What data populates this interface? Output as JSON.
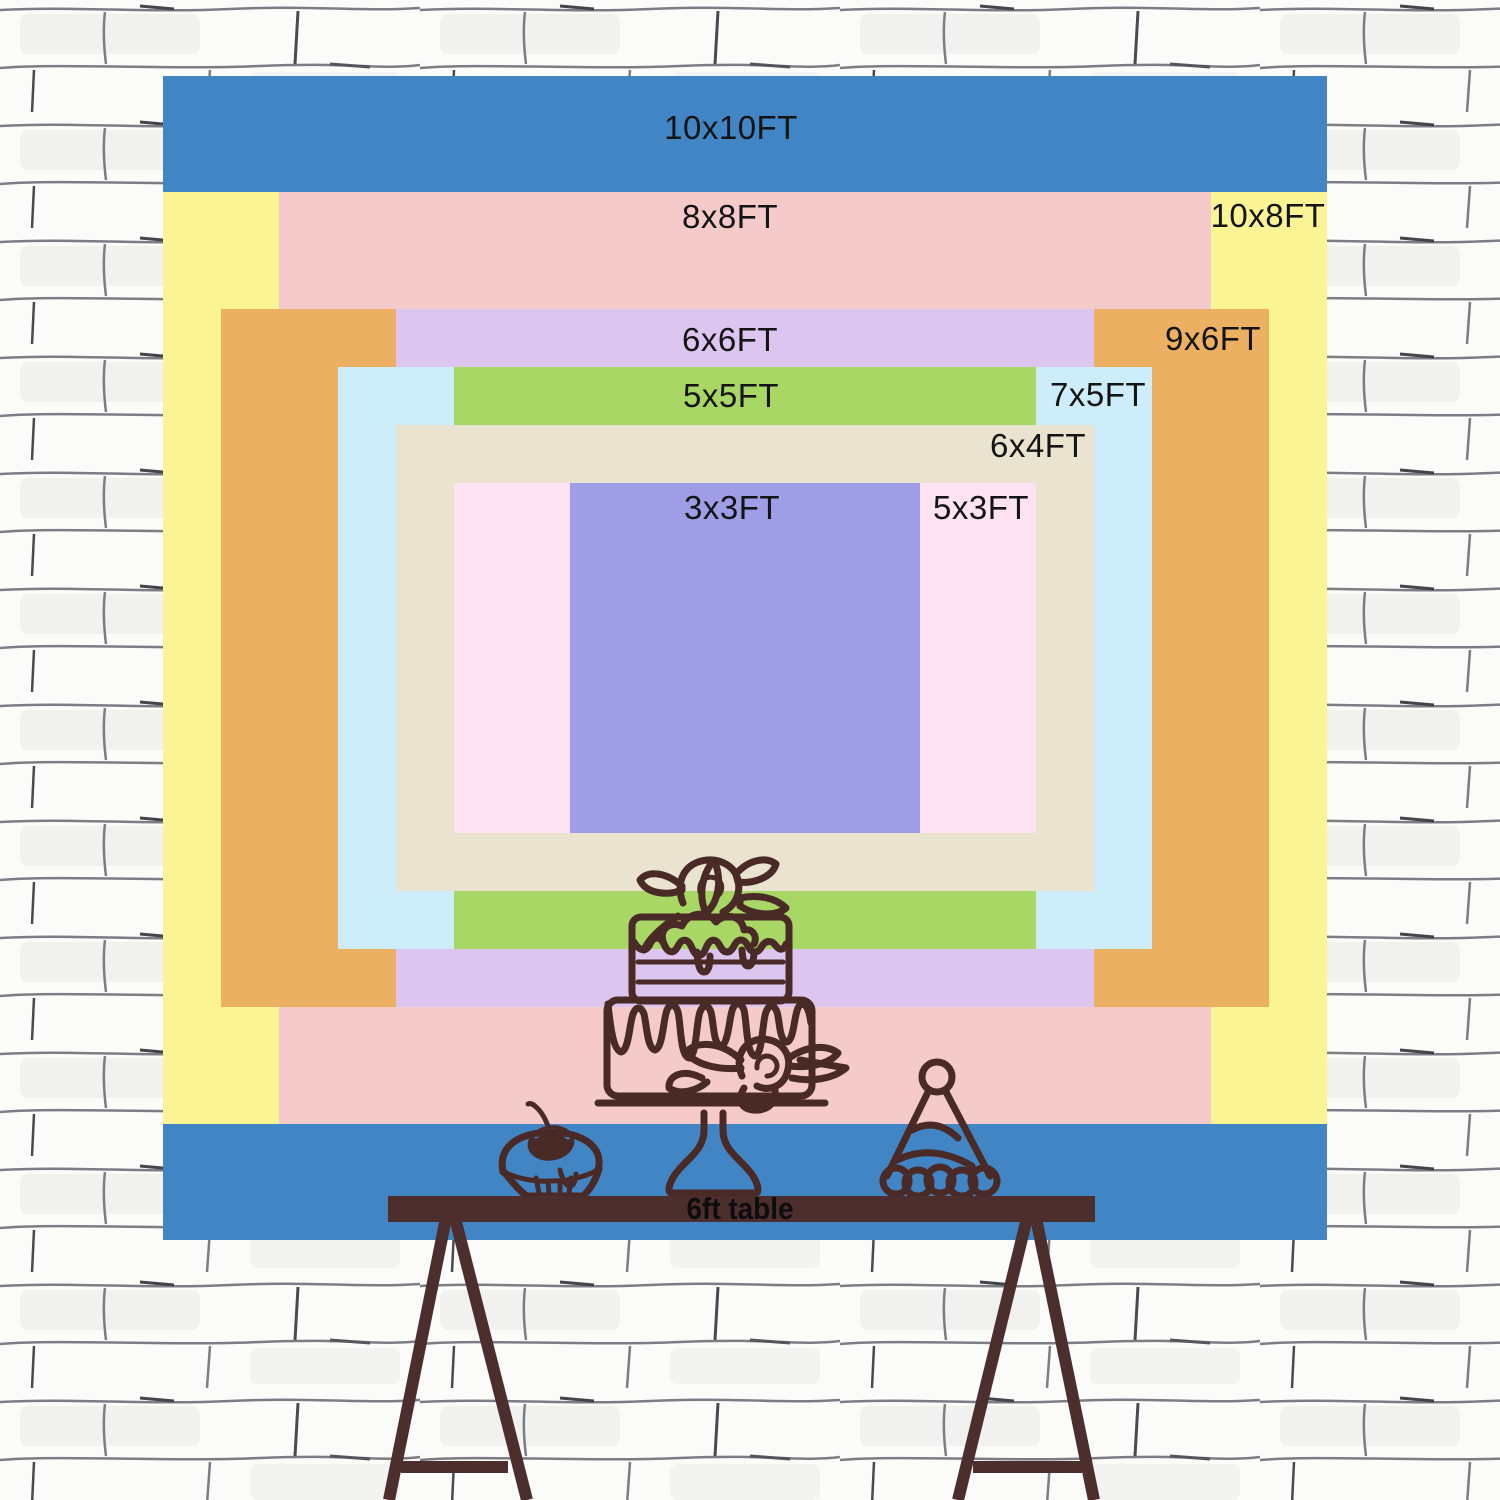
{
  "backdrop": {
    "layers": [
      {
        "id": "10x10ft",
        "label": "10x10FT",
        "width_ft": 10,
        "height_ft": 10,
        "color": "#4285c4"
      },
      {
        "id": "10x8ft",
        "label": "10x8FT",
        "width_ft": 10,
        "height_ft": 8,
        "color": "#fbf495"
      },
      {
        "id": "8x8ft",
        "label": "8x8FT",
        "width_ft": 8,
        "height_ft": 8,
        "color": "#f4caca"
      },
      {
        "id": "9x6ft",
        "label": "9x6FT",
        "width_ft": 9,
        "height_ft": 6,
        "color": "#ecb063"
      },
      {
        "id": "6x6ft",
        "label": "6x6FT",
        "width_ft": 6,
        "height_ft": 6,
        "color": "#dcc5ef"
      },
      {
        "id": "7x5ft",
        "label": "7x5FT",
        "width_ft": 7,
        "height_ft": 5,
        "color": "#cdedfa"
      },
      {
        "id": "5x5ft",
        "label": "5x5FT",
        "width_ft": 5,
        "height_ft": 5,
        "color": "#a8d765"
      },
      {
        "id": "6x4ft",
        "label": "6x4FT",
        "width_ft": 6,
        "height_ft": 4,
        "color": "#e9e3d0"
      },
      {
        "id": "5x3ft",
        "label": "5x3FT",
        "width_ft": 5,
        "height_ft": 3,
        "color": "#fde2f2"
      },
      {
        "id": "3x3ft",
        "label": "3x3FT",
        "width_ft": 3,
        "height_ft": 3,
        "color": "#9f9de6"
      }
    ]
  },
  "table": {
    "label": "6ft table"
  },
  "decorations": {
    "icons": [
      "cupcake-icon",
      "birthday-cake-icon",
      "party-hat-icon"
    ]
  },
  "colors": {
    "label_text": "#141414",
    "table": "#4c2e2c",
    "line_art": "#4a2a26"
  }
}
